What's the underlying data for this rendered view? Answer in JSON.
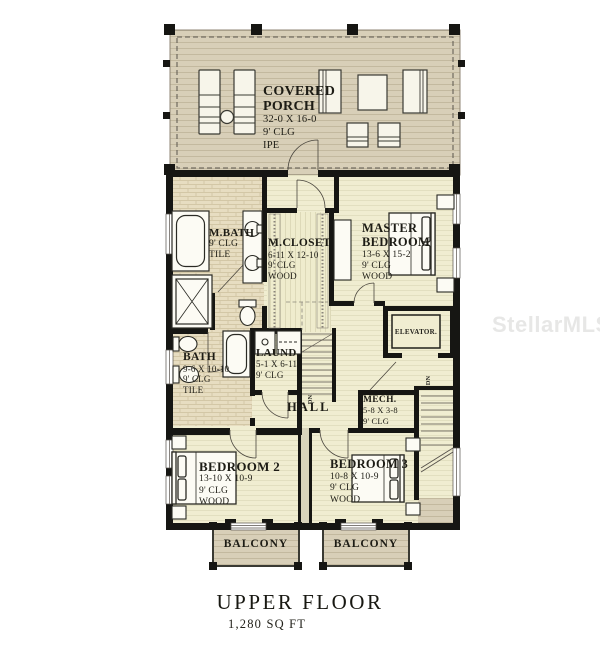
{
  "watermark": {
    "text": "StellarMLS"
  },
  "title": {
    "main": "UPPER FLOOR",
    "area": "1,280 SQ FT"
  },
  "markers": {
    "stairs_down": "DN"
  },
  "rooms": {
    "porch": {
      "name": "COVERED PORCH",
      "dims": "32-0 X 16-0",
      "clg": "9' CLG",
      "floor": "IPE"
    },
    "mbath": {
      "name": "M.BATH",
      "clg": "9' CLG",
      "floor": "TILE"
    },
    "mcloset": {
      "name": "M.CLOSET",
      "dims": "6-11 X 12-10",
      "clg": "9' CLG",
      "floor": "WOOD"
    },
    "master": {
      "name": "MASTER BEDROOM",
      "dims": "13-6 X 15-2",
      "clg": "9' CLG",
      "floor": "WOOD"
    },
    "elevator": {
      "name": "ELEVATOR."
    },
    "bath": {
      "name": "BATH",
      "dims": "9-6 X 10-10",
      "clg": "9' CLG",
      "floor": "TILE"
    },
    "laundry": {
      "name": "LAUND",
      "dims": "5-1 X 6-11",
      "clg": "9' CLG"
    },
    "hall": {
      "name": "HALL"
    },
    "mech": {
      "name": "MECH.",
      "dims": "5-8 X 3-8",
      "clg": "9' CLG"
    },
    "bedroom2": {
      "name": "BEDROOM 2",
      "dims": "13-10 X 10-9",
      "clg": "9' CLG",
      "floor": "WOOD"
    },
    "bedroom3": {
      "name": "BEDROOM 3",
      "dims": "10-8 X 10-9",
      "clg": "9' CLG",
      "floor": "WOOD"
    },
    "balcony_left": {
      "name": "BALCONY"
    },
    "balcony_right": {
      "name": "BALCONY"
    }
  },
  "colors": {
    "wall": "#161613",
    "floor": "#f0edd1",
    "tile": "#e7ddc1",
    "deck": "#d8cfb8",
    "text": "#1d1c15",
    "watermark": "#c3c3c0"
  }
}
